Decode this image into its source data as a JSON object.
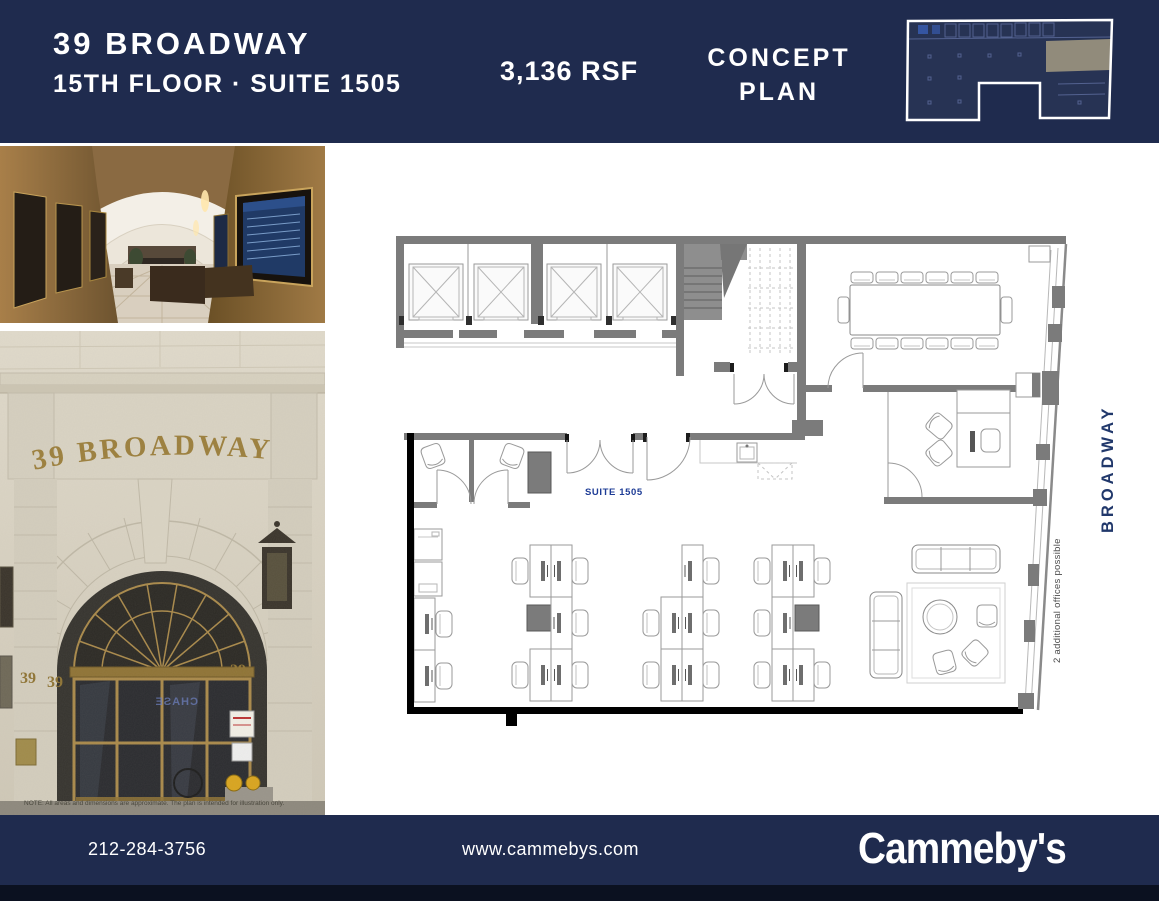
{
  "header": {
    "building_name": "39 BROADWAY",
    "floor_suite": "15TH FLOOR · SUITE 1505",
    "rsf": "3,136 RSF",
    "plan_type_line1": "CONCEPT",
    "plan_type_line2": "PLAN"
  },
  "photos": {
    "entrance_sign": "39 BROADWAY",
    "entrance_number": "39",
    "door_reflection": "CHASE",
    "note": "NOTE: All areas and dimensions are approximate. The plan is intended for illustration only."
  },
  "floor_plan": {
    "suite_label": "SUITE 1505",
    "street_label": "BROADWAY",
    "annotation": "2 additional offices possible"
  },
  "footer": {
    "phone": "212-284-3756",
    "website": "www.cammebys.com",
    "logo": "Cammeby's"
  },
  "colors": {
    "navy": "#1f2b4e",
    "suite_blue": "#1e3c96",
    "street_blue": "#21386b",
    "gold": "#9c7f3c",
    "wall_gray": "#7b7b7b",
    "keyplan_highlight": "#8d8776",
    "bottom_strip": "#0b1120"
  }
}
